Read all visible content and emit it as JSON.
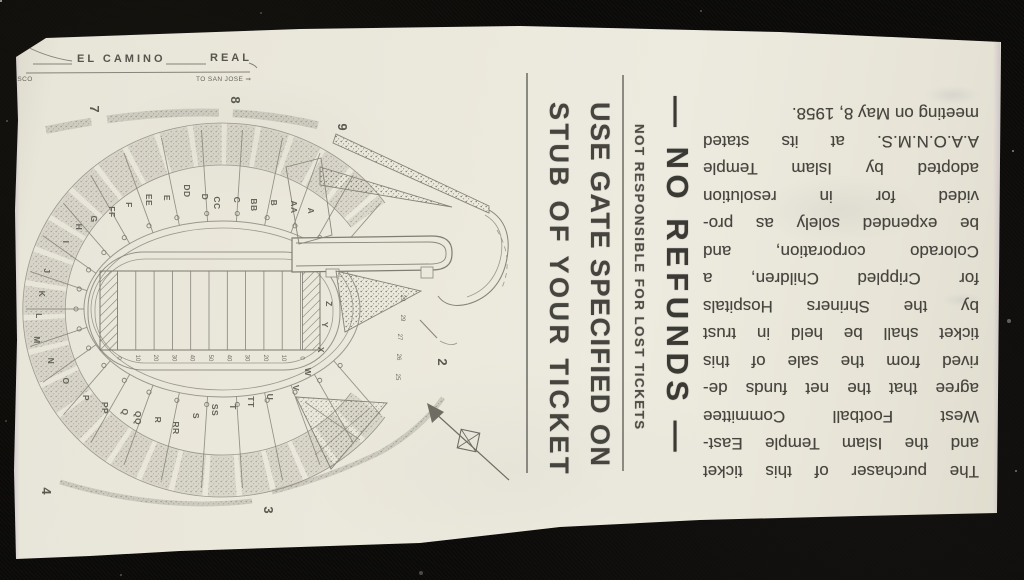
{
  "road": {
    "el_camino": "EL CAMINO",
    "real": "REAL",
    "to_san_francisco": "SAN FRANCISCO",
    "to_san_jose": "TO SAN JOSE ⇒"
  },
  "map": {
    "sections": [
      {
        "t": "A",
        "x": 308,
        "y": 211
      },
      {
        "t": "AA",
        "x": 291,
        "y": 207
      },
      {
        "t": "B",
        "x": 271,
        "y": 203
      },
      {
        "t": "BB",
        "x": 251,
        "y": 205
      },
      {
        "t": "C",
        "x": 234,
        "y": 200
      },
      {
        "t": "CC",
        "x": 214,
        "y": 203
      },
      {
        "t": "D",
        "x": 202,
        "y": 197
      },
      {
        "t": "DD",
        "x": 184,
        "y": 191
      },
      {
        "t": "E",
        "x": 164,
        "y": 198
      },
      {
        "t": "EE",
        "x": 146,
        "y": 200
      },
      {
        "t": "F",
        "x": 126,
        "y": 205
      },
      {
        "t": "FF",
        "x": 109,
        "y": 212
      },
      {
        "t": "G",
        "x": 91,
        "y": 219
      },
      {
        "t": "H",
        "x": 76,
        "y": 227
      },
      {
        "t": "I",
        "x": 63,
        "y": 242
      },
      {
        "t": "J",
        "x": 44,
        "y": 271
      },
      {
        "t": "K",
        "x": 39,
        "y": 294
      },
      {
        "t": "L",
        "x": 36,
        "y": 316
      },
      {
        "t": "M",
        "x": 34,
        "y": 340
      },
      {
        "t": "N",
        "x": 48,
        "y": 361
      },
      {
        "t": "O",
        "x": 63,
        "y": 381
      },
      {
        "t": "P",
        "x": 83,
        "y": 398
      },
      {
        "t": "PP",
        "x": 102,
        "y": 408
      },
      {
        "t": "Q",
        "x": 122,
        "y": 412
      },
      {
        "t": "QQ",
        "x": 135,
        "y": 418
      },
      {
        "t": "R",
        "x": 155,
        "y": 420
      },
      {
        "t": "RR",
        "x": 173,
        "y": 428
      },
      {
        "t": "S",
        "x": 193,
        "y": 416
      },
      {
        "t": "SS",
        "x": 212,
        "y": 410
      },
      {
        "t": "T",
        "x": 230,
        "y": 407
      },
      {
        "t": "TT",
        "x": 248,
        "y": 402
      },
      {
        "t": "U",
        "x": 267,
        "y": 397
      },
      {
        "t": "V",
        "x": 293,
        "y": 388
      },
      {
        "t": "W",
        "x": 305,
        "y": 372
      },
      {
        "t": "X",
        "x": 318,
        "y": 350
      },
      {
        "t": "Y",
        "x": 322,
        "y": 325
      },
      {
        "t": "Z",
        "x": 326,
        "y": 304
      }
    ],
    "gates": [
      {
        "t": "7",
        "x": 90,
        "y": 109
      },
      {
        "t": "8",
        "x": 231,
        "y": 100
      },
      {
        "t": "9",
        "x": 338,
        "y": 127
      },
      {
        "t": "2",
        "x": 438,
        "y": 362
      },
      {
        "t": "3",
        "x": 264,
        "y": 510
      },
      {
        "t": "4",
        "x": 42,
        "y": 491
      }
    ],
    "row_numbers": [
      {
        "t": "29",
        "x": 401,
        "y": 298
      },
      {
        "t": "29",
        "x": 401,
        "y": 318
      },
      {
        "t": "27",
        "x": 398,
        "y": 337
      },
      {
        "t": "26",
        "x": 397,
        "y": 357
      },
      {
        "t": "25",
        "x": 396,
        "y": 377
      }
    ],
    "yard_numbers": [
      "0",
      "10",
      "20",
      "30",
      "40",
      "50",
      "40",
      "30",
      "20",
      "10",
      "0"
    ]
  },
  "stub": {
    "line1": "USE GATE SPECIFIED ON",
    "line2": "STUB OF YOUR TICKET",
    "notice": "NOT RESPONSIBLE FOR LOST TICKETS",
    "no_refunds": "— NO REFUNDS —"
  },
  "legal": {
    "lines": [
      "The purchaser of this ticket",
      "and the Islam Temple East-",
      "West Football Committee",
      "agree that the net funds de-",
      "rived from the sale of this",
      "ticket shall be held in trust",
      "by the Shriners Hospitals",
      "for Crippled Children, a",
      "Colorado corporation, and",
      "be expended solely as pro-",
      "vided for in resolution",
      "adopted by Islam Temple",
      "A.A.O.N.M.S. at its stated",
      "meeting on May 8, 1958."
    ]
  }
}
